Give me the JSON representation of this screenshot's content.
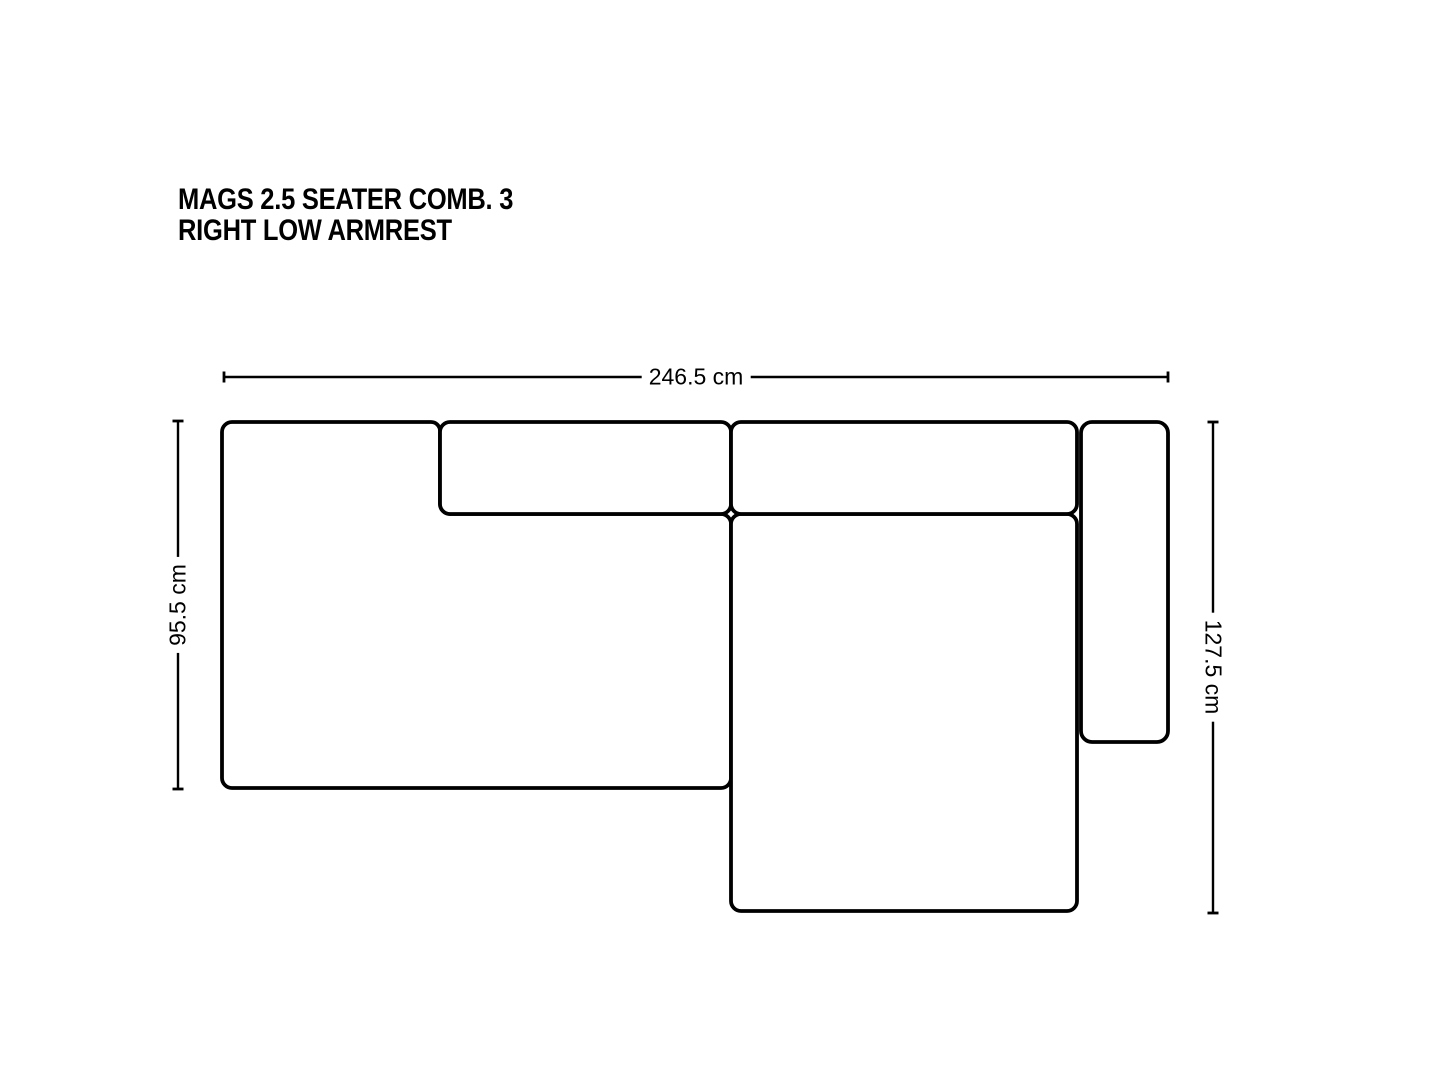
{
  "title": {
    "line1": "MAGS 2.5 SEATER COMB. 3",
    "line2": "RIGHT LOW ARMREST"
  },
  "dimensions": {
    "width": {
      "label": "246.5 cm"
    },
    "depth_left": {
      "label": "95.5 cm"
    },
    "depth_right": {
      "label": "127.5 cm"
    }
  },
  "colors": {
    "outline": "#000000",
    "dimension_line": "#000000",
    "text": "#000000",
    "background": "#ffffff"
  }
}
